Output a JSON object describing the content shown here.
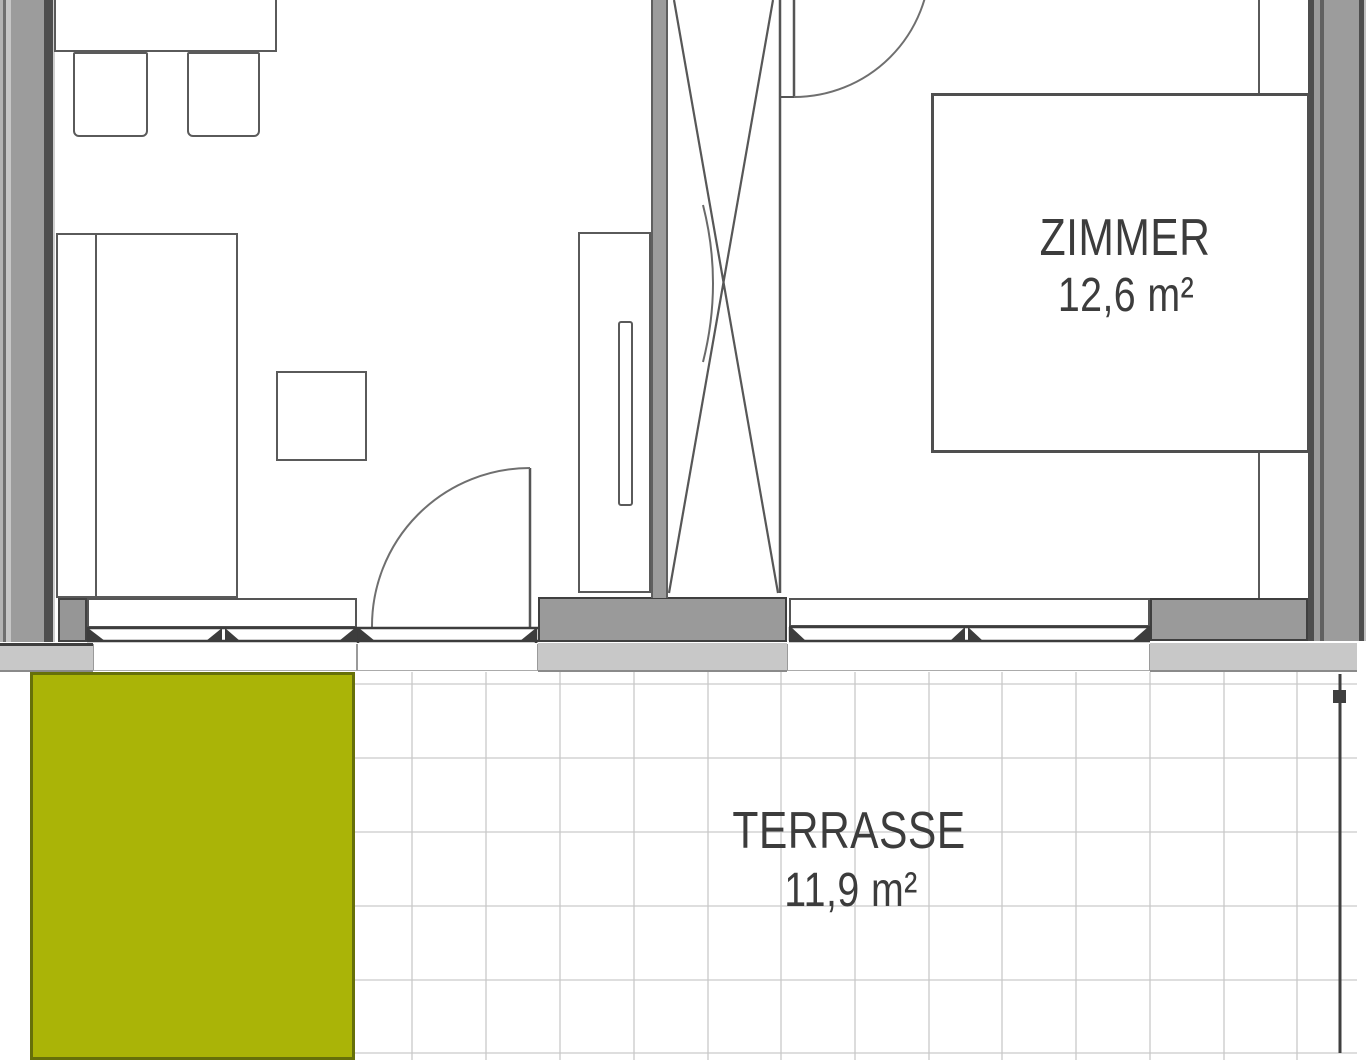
{
  "rooms": [
    {
      "id": "zimmer",
      "name": "ZIMMER",
      "area": "12,6 m²"
    },
    {
      "id": "terrasse",
      "name": "TERRASSE",
      "area": "11,9 m²"
    }
  ],
  "colors": {
    "lawn_green": "#aab407",
    "lawn_border": "#66700a",
    "wall_gray": "#9c9c9c",
    "band_light_gray": "#c8c8c8",
    "grid_line": "#c9c9c9",
    "line_dark": "#3d3d3d",
    "text": "#3c3c3c"
  }
}
